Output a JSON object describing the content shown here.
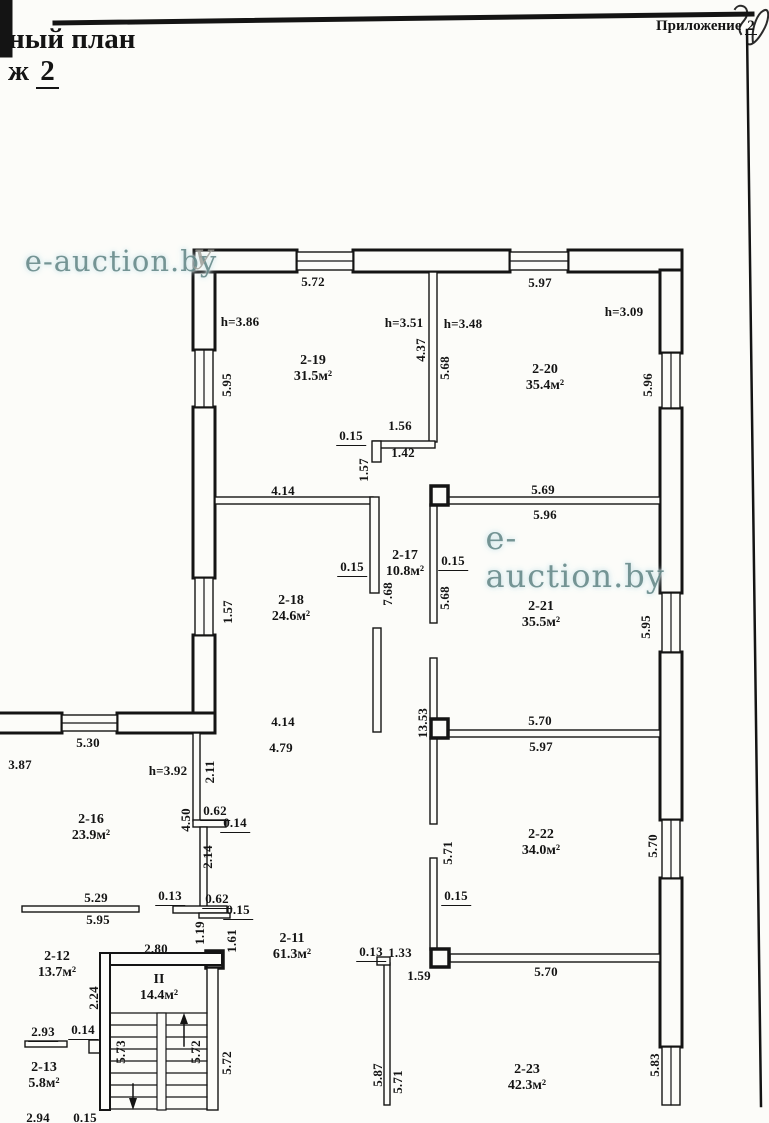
{
  "page": {
    "appendix_label": "Приложение",
    "appendix_number": "2",
    "title_line1": "ный план",
    "title_line2_prefix": "ж",
    "title_line2_number": "2",
    "watermark_text": "e-auction.by",
    "stray_mark": "У"
  },
  "colors": {
    "ink": "#141414",
    "paper": "#fcfcf9",
    "watermark": "#6d8f8f"
  },
  "rooms": [
    {
      "id": "2-19",
      "area": "31.5м²",
      "x": 313,
      "y": 369
    },
    {
      "id": "2-20",
      "area": "35.4м²",
      "x": 545,
      "y": 378
    },
    {
      "id": "2-17",
      "area": "10.8м²",
      "x": 405,
      "y": 564
    },
    {
      "id": "2-18",
      "area": "24.6м²",
      "x": 291,
      "y": 609
    },
    {
      "id": "2-21",
      "area": "35.5м²",
      "x": 541,
      "y": 615
    },
    {
      "id": "2-16",
      "area": "23.9м²",
      "x": 91,
      "y": 828
    },
    {
      "id": "2-22",
      "area": "34.0м²",
      "x": 541,
      "y": 843
    },
    {
      "id": "2-11",
      "area": "61.3м²",
      "x": 292,
      "y": 947
    },
    {
      "id": "2-12",
      "area": "13.7м²",
      "x": 57,
      "y": 965
    },
    {
      "id": "II",
      "area": "14.4м²",
      "x": 159,
      "y": 988
    },
    {
      "id": "2-13",
      "area": "5.8м²",
      "x": 44,
      "y": 1076
    },
    {
      "id": "2-23",
      "area": "42.3м²",
      "x": 527,
      "y": 1078
    }
  ],
  "dimensions": [
    {
      "t": "5.72",
      "x": 313,
      "y": 282
    },
    {
      "t": "5.97",
      "x": 540,
      "y": 283
    },
    {
      "t": "h=3.86",
      "x": 240,
      "y": 322
    },
    {
      "t": "h=3.51",
      "x": 404,
      "y": 323
    },
    {
      "t": "h=3.48",
      "x": 463,
      "y": 324
    },
    {
      "t": "h=3.09",
      "x": 624,
      "y": 312
    },
    {
      "t": "5.95",
      "x": 227,
      "y": 385,
      "rot": 1
    },
    {
      "t": "4.37",
      "x": 421,
      "y": 350,
      "rot": 1
    },
    {
      "t": "5.68",
      "x": 445,
      "y": 368,
      "rot": 1
    },
    {
      "t": "5.96",
      "x": 648,
      "y": 385,
      "rot": 1
    },
    {
      "t": "0.15",
      "x": 351,
      "y": 437,
      "u": 1
    },
    {
      "t": "1.56",
      "x": 400,
      "y": 426
    },
    {
      "t": "1.42",
      "x": 403,
      "y": 453
    },
    {
      "t": "1.57",
      "x": 364,
      "y": 470,
      "rot": 1
    },
    {
      "t": "4.14",
      "x": 283,
      "y": 491
    },
    {
      "t": "5.69",
      "x": 543,
      "y": 490
    },
    {
      "t": "5.96",
      "x": 545,
      "y": 515
    },
    {
      "t": "0.15",
      "x": 352,
      "y": 568,
      "u": 1
    },
    {
      "t": "0.15",
      "x": 453,
      "y": 562,
      "u": 1
    },
    {
      "t": "7.68",
      "x": 388,
      "y": 594,
      "rot": 1
    },
    {
      "t": "5.68",
      "x": 445,
      "y": 598,
      "rot": 1
    },
    {
      "t": "1.57",
      "x": 228,
      "y": 612,
      "rot": 1
    },
    {
      "t": "5.95",
      "x": 646,
      "y": 627,
      "rot": 1
    },
    {
      "t": "4.14",
      "x": 283,
      "y": 722
    },
    {
      "t": "4.79",
      "x": 281,
      "y": 748
    },
    {
      "t": "13.53",
      "x": 423,
      "y": 723,
      "rot": 1
    },
    {
      "t": "5.70",
      "x": 540,
      "y": 721
    },
    {
      "t": "5.97",
      "x": 541,
      "y": 747
    },
    {
      "t": "5.30",
      "x": 88,
      "y": 743
    },
    {
      "t": "3.87",
      "x": 20,
      "y": 765
    },
    {
      "t": "h=3.92",
      "x": 168,
      "y": 771
    },
    {
      "t": "2.11",
      "x": 210,
      "y": 772,
      "rot": 1
    },
    {
      "t": "4.50",
      "x": 186,
      "y": 820,
      "rot": 1
    },
    {
      "t": "0.62",
      "x": 215,
      "y": 812,
      "u": 1
    },
    {
      "t": "0.14",
      "x": 235,
      "y": 824,
      "u": 1
    },
    {
      "t": "2.14",
      "x": 208,
      "y": 857,
      "rot": 1
    },
    {
      "t": "5.70",
      "x": 653,
      "y": 846,
      "rot": 1
    },
    {
      "t": "5.71",
      "x": 448,
      "y": 853,
      "rot": 1
    },
    {
      "t": "0.15",
      "x": 456,
      "y": 897,
      "u": 1
    },
    {
      "t": "5.29",
      "x": 96,
      "y": 898
    },
    {
      "t": "5.95",
      "x": 98,
      "y": 920
    },
    {
      "t": "0.13",
      "x": 170,
      "y": 897,
      "u": 1
    },
    {
      "t": "0.62",
      "x": 217,
      "y": 900,
      "u": 1
    },
    {
      "t": "0.15",
      "x": 238,
      "y": 911,
      "u": 1
    },
    {
      "t": "1.19",
      "x": 200,
      "y": 933,
      "rot": 1
    },
    {
      "t": "1.61",
      "x": 232,
      "y": 941,
      "rot": 1
    },
    {
      "t": "2.80",
      "x": 156,
      "y": 949
    },
    {
      "t": "0.13",
      "x": 371,
      "y": 953,
      "u": 1
    },
    {
      "t": "1.33",
      "x": 400,
      "y": 953
    },
    {
      "t": "1.59",
      "x": 419,
      "y": 976
    },
    {
      "t": "5.70",
      "x": 546,
      "y": 972
    },
    {
      "t": "2.24",
      "x": 94,
      "y": 998,
      "rot": 1
    },
    {
      "t": "2.93",
      "x": 43,
      "y": 1033,
      "u": 1
    },
    {
      "t": "0.14",
      "x": 83,
      "y": 1031,
      "u": 1
    },
    {
      "t": "5.73",
      "x": 121,
      "y": 1052,
      "rot": 1
    },
    {
      "t": "5.72",
      "x": 196,
      "y": 1052,
      "rot": 1
    },
    {
      "t": "5.72",
      "x": 227,
      "y": 1063,
      "rot": 1
    },
    {
      "t": "5.87",
      "x": 378,
      "y": 1075,
      "rot": 1
    },
    {
      "t": "5.71",
      "x": 398,
      "y": 1082,
      "rot": 1
    },
    {
      "t": "5.83",
      "x": 655,
      "y": 1065,
      "rot": 1
    },
    {
      "t": "2.94",
      "x": 38,
      "y": 1118
    },
    {
      "t": "0.15",
      "x": 85,
      "y": 1118
    }
  ]
}
